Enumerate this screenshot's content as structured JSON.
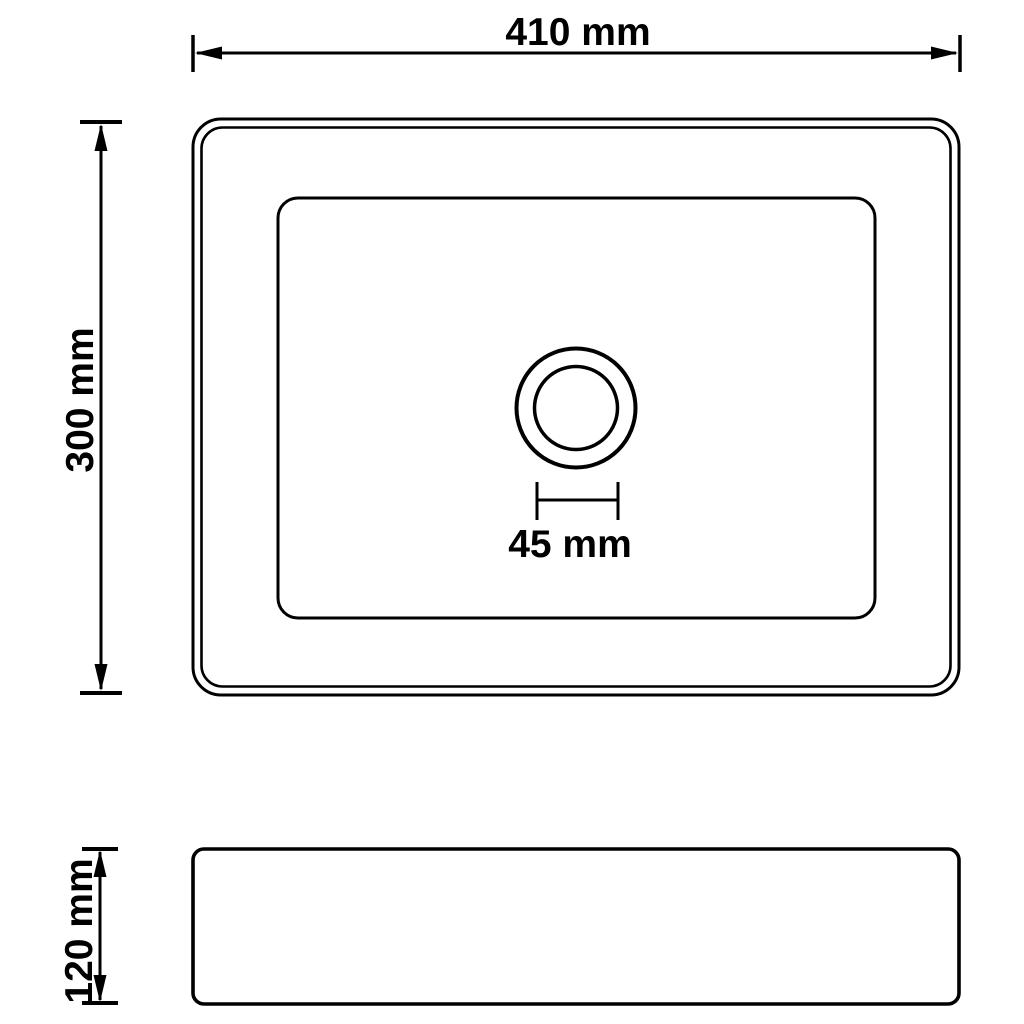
{
  "page": {
    "background_color": "#ffffff",
    "line_color": "#000000",
    "description_texts": []
  },
  "drawing": {
    "labels": {
      "overall_width": "410 mm",
      "overall_depth": "300 mm",
      "drain_width": "45 mm",
      "body_height": "120 mm"
    },
    "values": {
      "overall_width_mm": 410,
      "overall_depth_mm": 300,
      "drain_width_mm": 45,
      "body_height_mm": 120,
      "unit": "mm"
    }
  }
}
